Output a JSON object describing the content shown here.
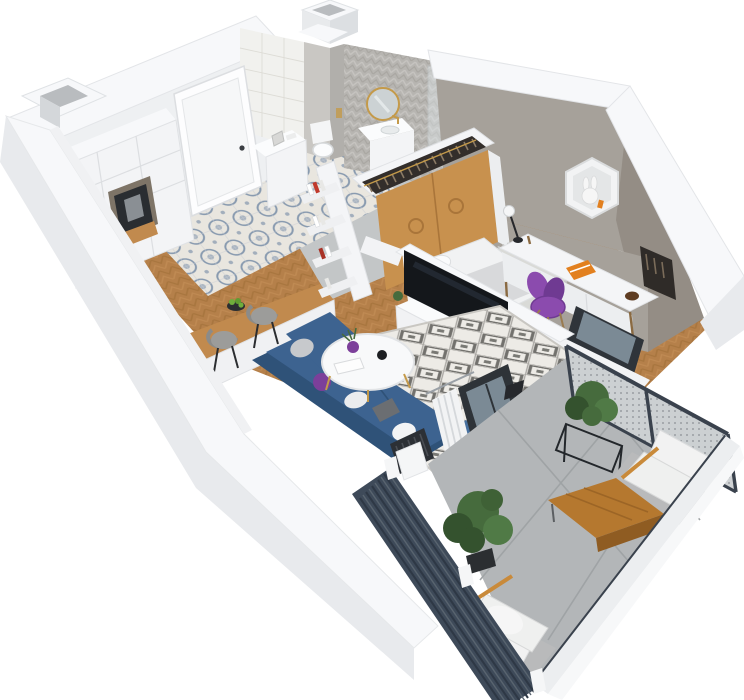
{
  "scene": {
    "type": "isometric-3d-floor-plan-render",
    "description": "Top-down isometric 3D render of a one-bedroom apartment with balcony",
    "rooms": [
      {
        "name": "kitchen-dining",
        "features": [
          "white-tall-cabinets",
          "coffee-machine",
          "l-shaped-wood-counter",
          "cooktop",
          "sink",
          "fruit-bowl",
          "two-bar-stools",
          "patterned-tile-floor"
        ]
      },
      {
        "name": "hallway",
        "features": [
          "entrance-door",
          "shoe-cabinet",
          "leaning-bookshelf",
          "concrete-tile-floor"
        ]
      },
      {
        "name": "bathroom",
        "features": [
          "herringbone-tile-wall",
          "subway-tile-wall",
          "round-gold-mirror",
          "vanity-sink",
          "toilet",
          "glass-shower",
          "duct-column"
        ]
      },
      {
        "name": "living-room",
        "features": [
          "blue-corner-sofa",
          "pillows",
          "round-coffee-table",
          "diamond-pattern-rug",
          "tv-media-unit",
          "tv",
          "curtain",
          "balcony-slider",
          "radiator",
          "floor-lamp",
          "herringbone-wood-floor"
        ]
      },
      {
        "name": "bedroom",
        "features": [
          "gray-feature-wall",
          "hexagon-wall-shelf",
          "plush-bunny",
          "white-desk",
          "desk-lamp",
          "orange-book",
          "purple-chair",
          "open-wardrobe-with-clothes",
          "oak-sliding-doors",
          "bed",
          "shaggy-rug",
          "window-to-balcony"
        ]
      },
      {
        "name": "balcony",
        "features": [
          "mesh-railing",
          "dark-slatted-privacy-screens",
          "concrete-slab-floor",
          "two-gray-armchairs-white-cushions",
          "wood-coffee-table",
          "potted-plants",
          "plant-stand"
        ]
      }
    ],
    "objects": [
      "exterior-white-walls",
      "wall-top-band",
      "duct-shaft-top-left",
      "roof-shaft-top",
      "entrance-door-handle",
      "hanger-rail-clothes",
      "tv-decor-plant",
      "gold-bowl",
      "book-stack",
      "purple-vase",
      "black-jar",
      "apples-green"
    ]
  },
  "palette": {
    "bg": "#ffffff",
    "wall_top": "#f7f8fa",
    "wall_face": "#eef0f2",
    "wall_outer": "#e8eaed",
    "wall_shade": "#dcdfe2",
    "gray_wall": "#a6a19a",
    "gray_wall_dark": "#948d85",
    "floor_wood": "#b5804a",
    "wood_dark": "#9c6b34",
    "wood_light": "#c9945c",
    "tile_base": "#e9e6df",
    "tile_blue": "#68809f",
    "concrete": "#c3c6c7",
    "concrete_grout": "#a9acae",
    "balcony_floor": "#b3b6b8",
    "cabinet": "#f3f4f6",
    "cabinet_shade": "#e2e4e7",
    "counter_wood": "#c18a4e",
    "counter_side": "#a5763c",
    "sofa": "#3d6390",
    "sofa_dark": "#2f5278",
    "sofa_light": "#48719f",
    "rug_base": "#edebe6",
    "rug_pattern": "#5d5c58",
    "shag_rug": "#d9dad7",
    "tv_black": "#14171b",
    "desk_white": "#f4f5f7",
    "chair_purple": "#8b4bae",
    "chair_purple_dark": "#6f3a92",
    "oak": "#c8914e",
    "oak_dark": "#a9753a",
    "clothes_dark": "#332e2b",
    "screen_dark": "#3e4a59",
    "screen_line": "#2e3845",
    "rail_frame": "#3a424d",
    "mesh": "#cdd1d3",
    "plant": "#466b3d",
    "plant_dark": "#34522e",
    "gold": "#c49a4a",
    "ink": "#23262b",
    "orange": "#e2801f",
    "mirror_glass": "#ccd2d4",
    "bath_tile": "#b7b5b1",
    "bath_tile_light": "#c8c6c2",
    "subway": "#f1f1ee",
    "pillow_gray": "#c7c9cc",
    "pillow_white": "#ebecee",
    "purple": "#7c3f9a",
    "apple": "#6fae3c",
    "stool_gray": "#9c9c9a",
    "bed_white": "#f1f2f3",
    "blanket": "#d8d9db",
    "radiator": "#2c3035",
    "glass": "#8ea0ac",
    "chair_frame": "#b9babb",
    "cushion": "#eff0ef"
  }
}
